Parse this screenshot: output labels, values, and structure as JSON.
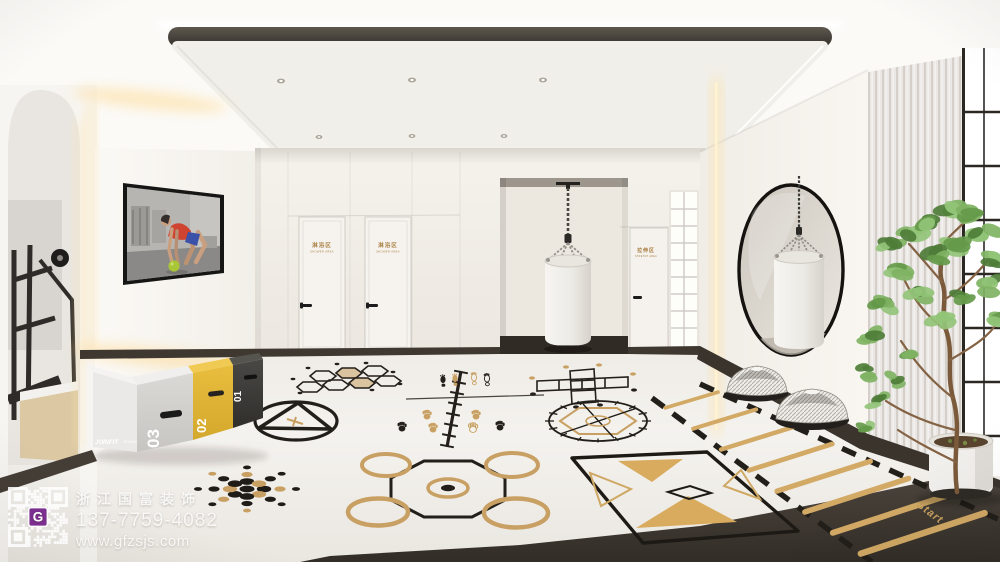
{
  "watermark": {
    "company": "浙江国富装饰",
    "phone": "137-7759-4082",
    "website": "www.gfzsjs.com",
    "logo": "G"
  },
  "signs": {
    "shower1": {
      "cn": "淋浴区",
      "en": "SHOWER AREA"
    },
    "shower2": {
      "cn": "淋浴区",
      "en": "SHOWER AREA"
    },
    "stretch": {
      "cn": "拉伸区",
      "en": "STRETCH AREA"
    }
  },
  "equipment": {
    "plyo_boxes": {
      "brand": "JOINFIT",
      "size": "16\"/40cm",
      "numbers": [
        "01",
        "02",
        "03"
      ]
    }
  },
  "floor": {
    "start_label": "Start"
  },
  "colors": {
    "gold": "#c9a063",
    "ladder_gold": "#d2a965",
    "box_yellow": "#e3b93b",
    "ink_black": "#241f1a",
    "wall": "#f4f1ec",
    "floor": "#f1efeb",
    "dark_wood": "#3f3831",
    "qr_purple": "#7b2f8e",
    "leaf_green": "#6f9e52"
  }
}
